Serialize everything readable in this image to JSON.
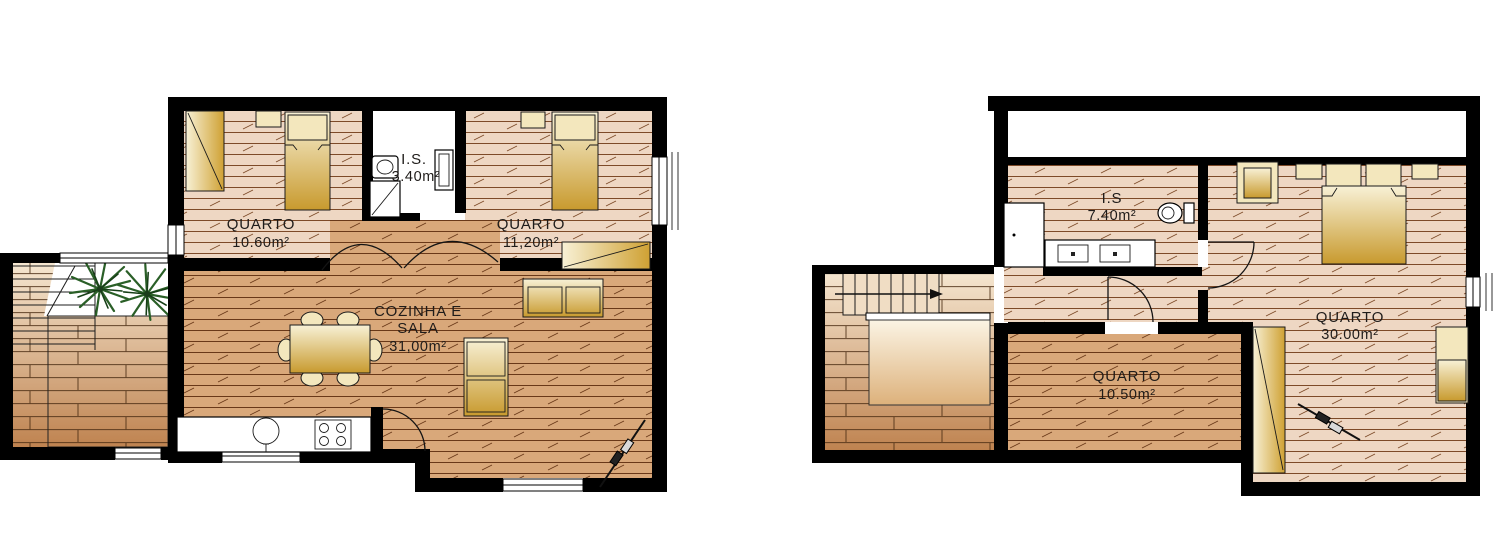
{
  "drawing": {
    "type": "architectural-floor-plans",
    "plans": [
      {
        "title": "ground-floor-plan",
        "rooms": [
          {
            "label": "QUARTO",
            "area": "10.60m²"
          },
          {
            "label": "I.S.",
            "area": "3.40m²"
          },
          {
            "label": "QUARTO",
            "area": "11,20m²"
          },
          {
            "label_line1": "COZINHA E",
            "label_line2": "SALA",
            "area": "31,00m²"
          }
        ],
        "furniture": [
          "wardrobe",
          "single-bed",
          "nightstand",
          "single-bed",
          "nightstand",
          "wardrobe",
          "sofa",
          "armchair",
          "dining-table",
          "chairs",
          "kitchen-counter",
          "sink",
          "stove",
          "shower",
          "washbasin",
          "plants",
          "deck-stairs",
          "section-marker"
        ]
      },
      {
        "title": "upper-floor-plan",
        "rooms": [
          {
            "label": "I.S",
            "area": "7.40m²"
          },
          {
            "label": "QUARTO",
            "area": "30.00m²"
          },
          {
            "label": "QUARTO",
            "area": "10.50m²"
          }
        ],
        "furniture": [
          "shower",
          "double-vanity",
          "toilet",
          "dresser",
          "double-bed",
          "nightstand",
          "nightstand",
          "wardrobe",
          "dresser",
          "stairs-up-arrow",
          "section-marker"
        ]
      }
    ],
    "colors": {
      "wall": "#000000",
      "floor_pale": "#eed7c3",
      "floor_tan": "#d9a87a",
      "plank_line": "#6e3a1d",
      "deck_light": "#f5e6d0",
      "deck_dark": "#bf8350",
      "furniture_light": "#f8f1d6",
      "furniture_gold": "#c89a2e",
      "plant_green": "#2a5f27",
      "fixture_white": "#ffffff",
      "label_text": "#1f1c1a",
      "background": "#ffffff"
    }
  }
}
